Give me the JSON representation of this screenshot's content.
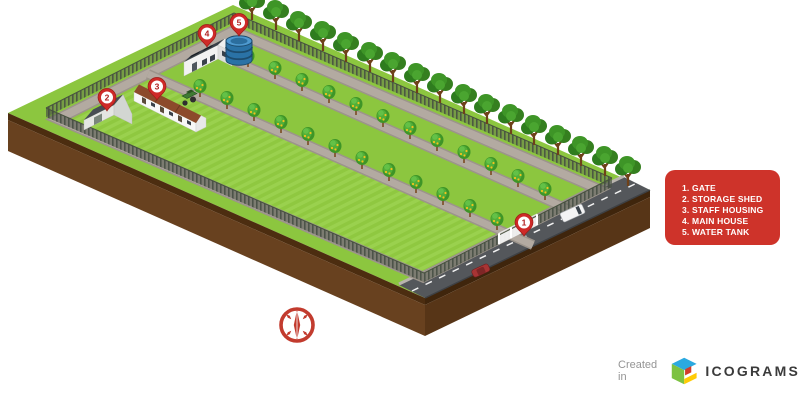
{
  "map": {
    "markers": [
      {
        "number": "1",
        "label": "Gate"
      },
      {
        "number": "2",
        "label": "Storage Shed"
      },
      {
        "number": "3",
        "label": "Staff Housing"
      },
      {
        "number": "4",
        "label": "Main House"
      },
      {
        "number": "5",
        "label": "Water Tank"
      }
    ]
  },
  "legend": {
    "items": [
      "1. GATE",
      "2. STORAGE SHED",
      "3. STAFF HOUSING",
      "4. MAIN HOUSE",
      "5. WATER TANK"
    ]
  },
  "footer": {
    "created_in": "Created in",
    "brand": "ICOGRAMS"
  },
  "colors": {
    "legend_background": "#CE332A",
    "pin_red": "#CE2A28",
    "field_green": "#8CC63F",
    "crop_stripe_green": "#9AD14E",
    "earth_brown": "#68411F",
    "road_gray": "#54575B",
    "water_tank_blue": "#2A72A6"
  }
}
